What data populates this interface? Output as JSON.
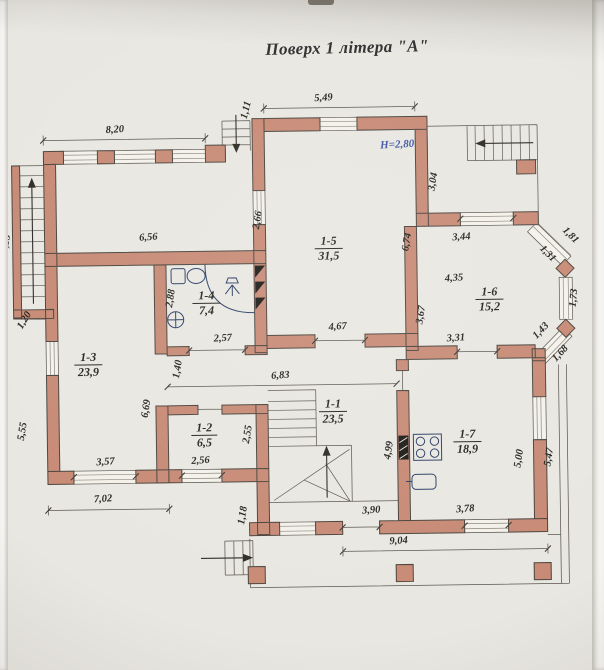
{
  "title": "Поверх 1 літера \"А\"",
  "plan": {
    "height_label": "H=2,80",
    "rooms": [
      {
        "id": "1-1",
        "area": "23,5"
      },
      {
        "id": "1-2",
        "area": "6,5"
      },
      {
        "id": "1-3",
        "area": "23,9"
      },
      {
        "id": "1-4",
        "area": "7,4"
      },
      {
        "id": "1-5",
        "area": "31,5"
      },
      {
        "id": "1-6",
        "area": "15,2"
      },
      {
        "id": "1-7",
        "area": "18,9"
      }
    ],
    "dims": {
      "d820": "8,20",
      "d549": "5,49",
      "d111": "1,11",
      "d304": "3,04",
      "d674": "6,74",
      "d344": "3,44",
      "d266": "2,66",
      "d656": "6,56",
      "d435": "4,35",
      "d181": "1,81",
      "d131": "1,31",
      "d173": "1,73",
      "d143": "1,43",
      "d168": "1,68",
      "d367": "3,67",
      "d331": "3,31",
      "d288": "2,88",
      "d257": "2,57",
      "d140": "1,40",
      "d683": "6,83",
      "d467": "4,67",
      "d669": "6,69",
      "d120": "1,20",
      "d313": "3,13",
      "d555": "5,55",
      "d357": "3,57",
      "d702": "7,02",
      "d255": "2,55",
      "d256": "2,56",
      "d118": "1,18",
      "d499": "4,99",
      "d500": "5,00",
      "d547": "5,47",
      "d390": "3,90",
      "d378": "3,78",
      "d904": "9,04"
    },
    "colors": {
      "wall": "#c78a75",
      "fixture": "#2c3f66",
      "height_label": "#3a56a5",
      "vent": "#1d1b16"
    }
  }
}
